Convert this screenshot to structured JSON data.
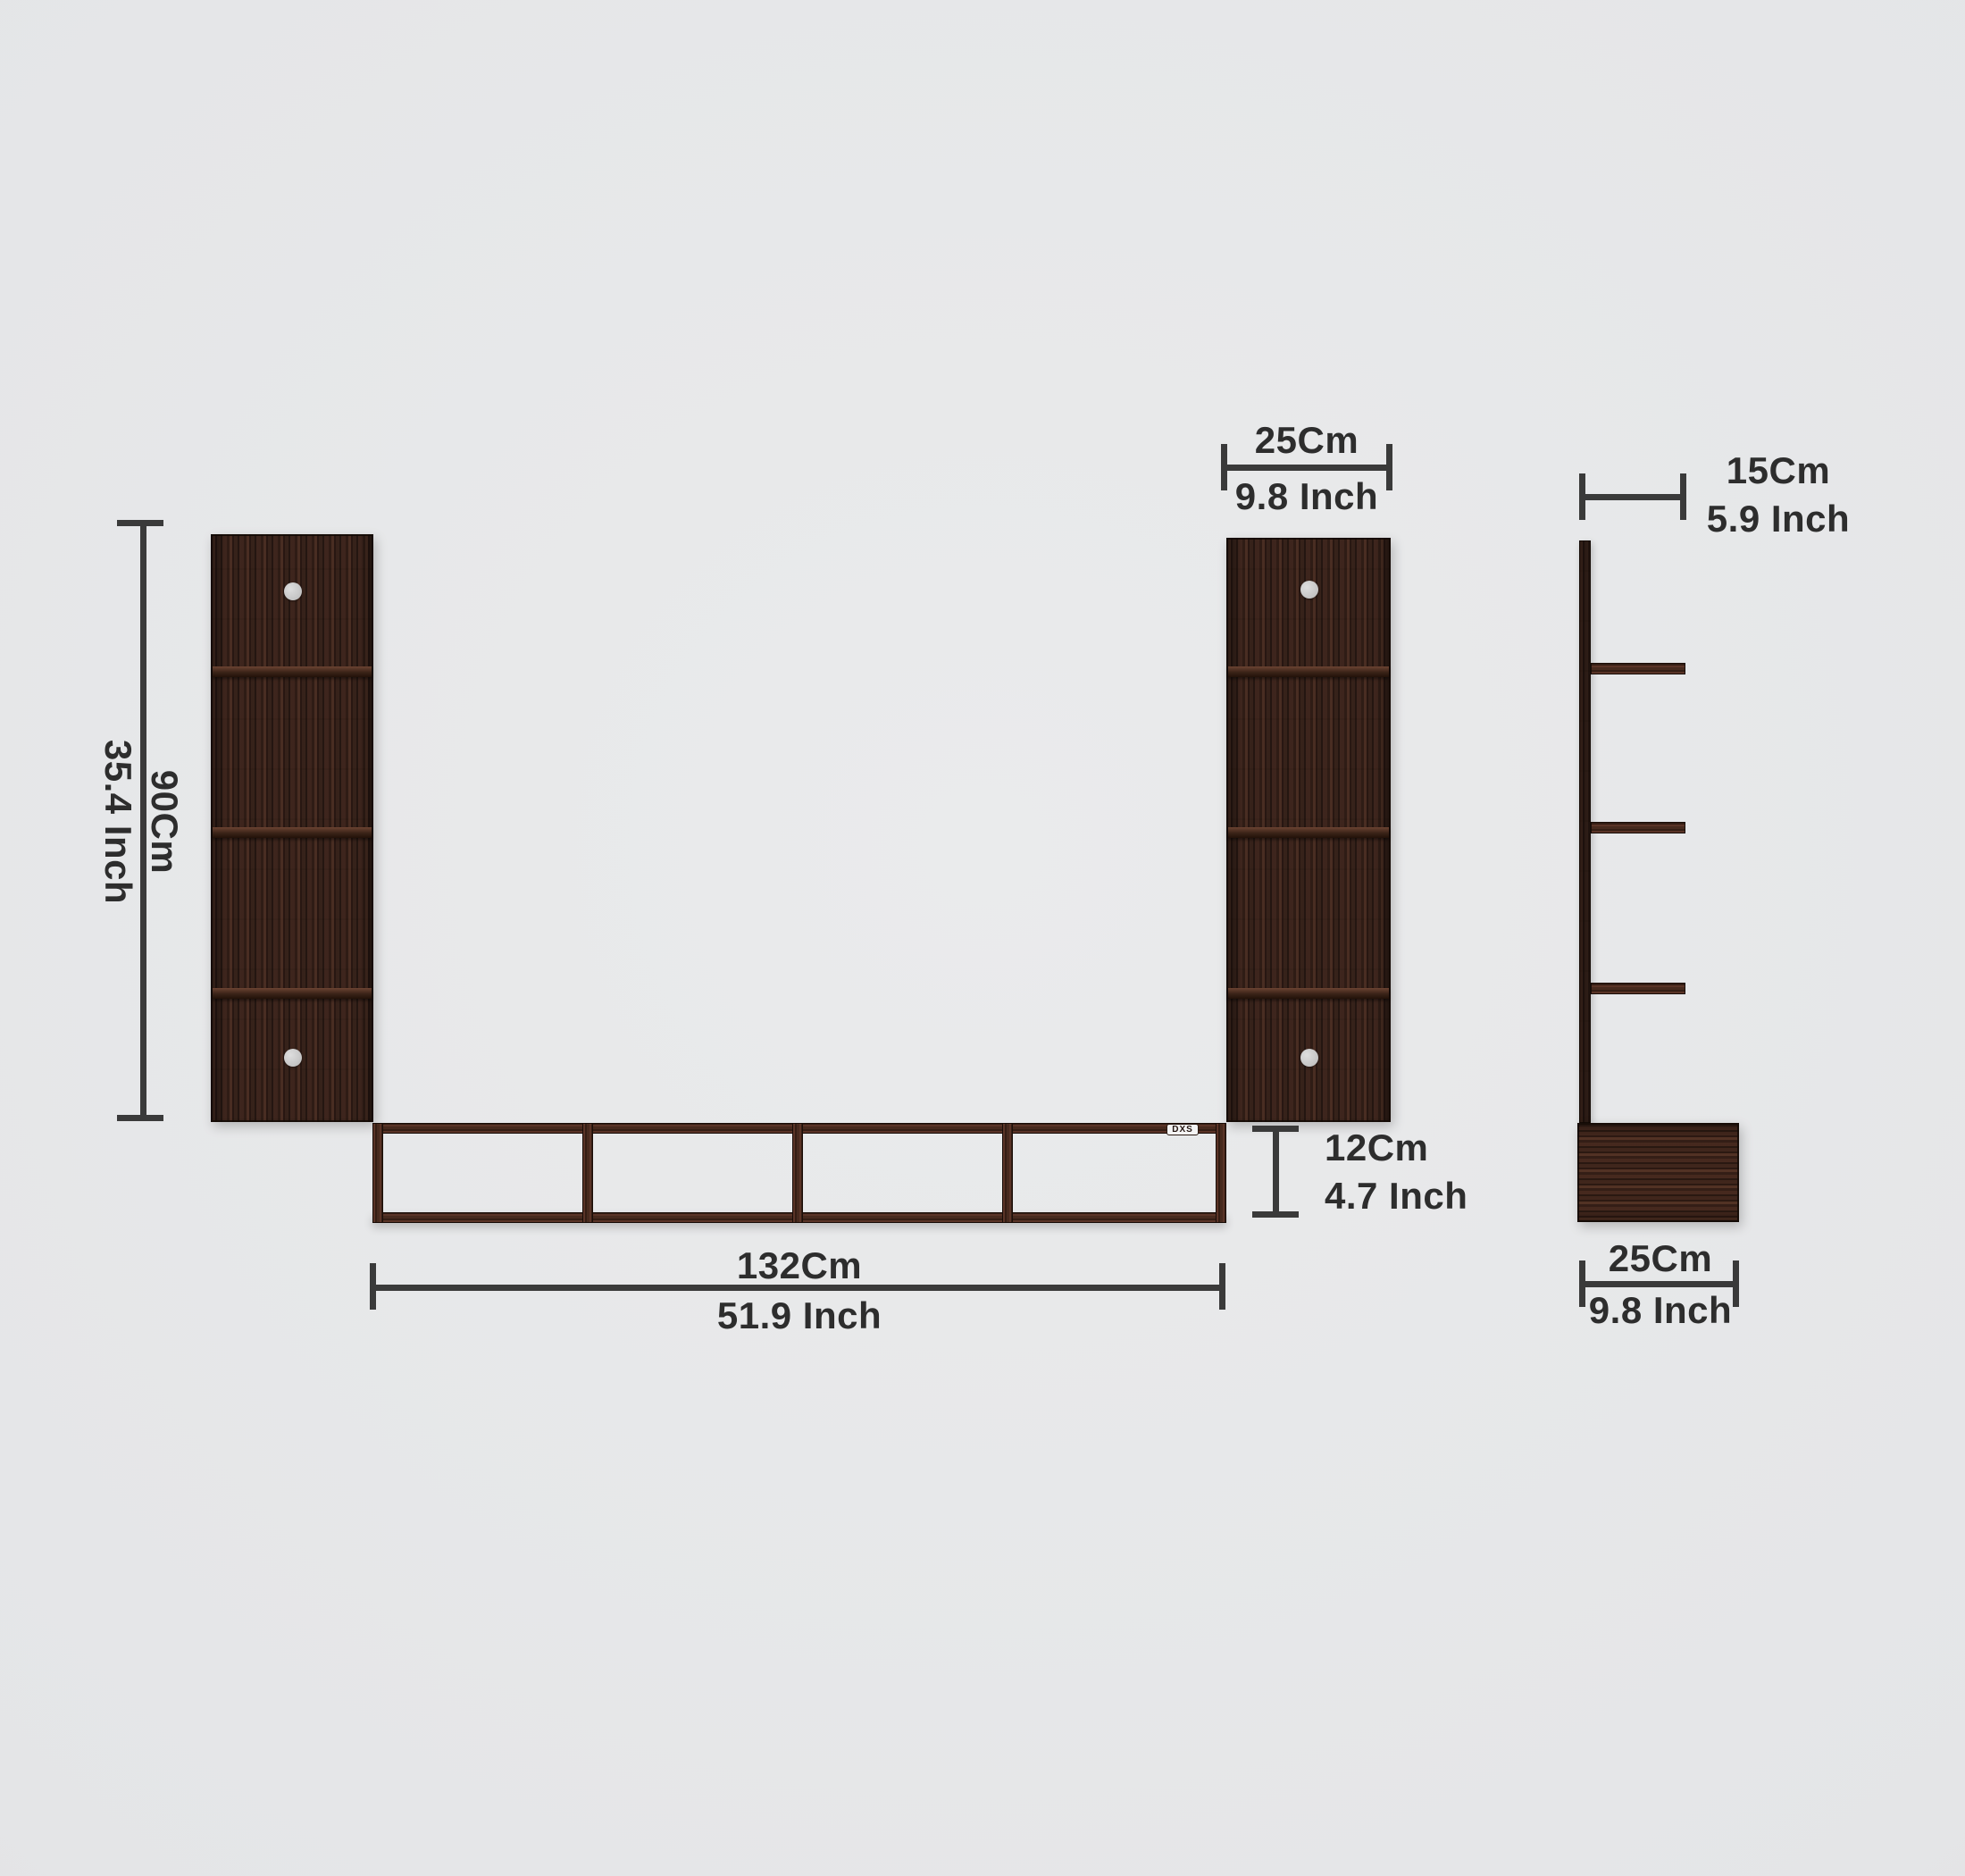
{
  "logo": {
    "text": "DXS"
  },
  "dimensions": {
    "height": {
      "cm": "90Cm",
      "inch": "35.4 Inch"
    },
    "panel_width": {
      "cm": "25Cm",
      "inch": "9.8 Inch"
    },
    "shelf_length": {
      "cm": "132Cm",
      "inch": "51.9 Inch"
    },
    "shelf_height": {
      "cm": "12Cm",
      "inch": "4.7 Inch"
    },
    "side_depth_top": {
      "cm": "15Cm",
      "inch": "5.9 Inch"
    },
    "side_depth_bottom": {
      "cm": "25Cm",
      "inch": "9.8 Inch"
    }
  },
  "colors": {
    "background": "#e4e5e7",
    "wood_dark": "#33201a",
    "wood_frame": "#47291e",
    "dimension_line": "#3a3a3a",
    "dimension_text": "#2d2d2d",
    "screw_dot": "#c9c9c9",
    "logo_bg": "#f4f4f4"
  }
}
